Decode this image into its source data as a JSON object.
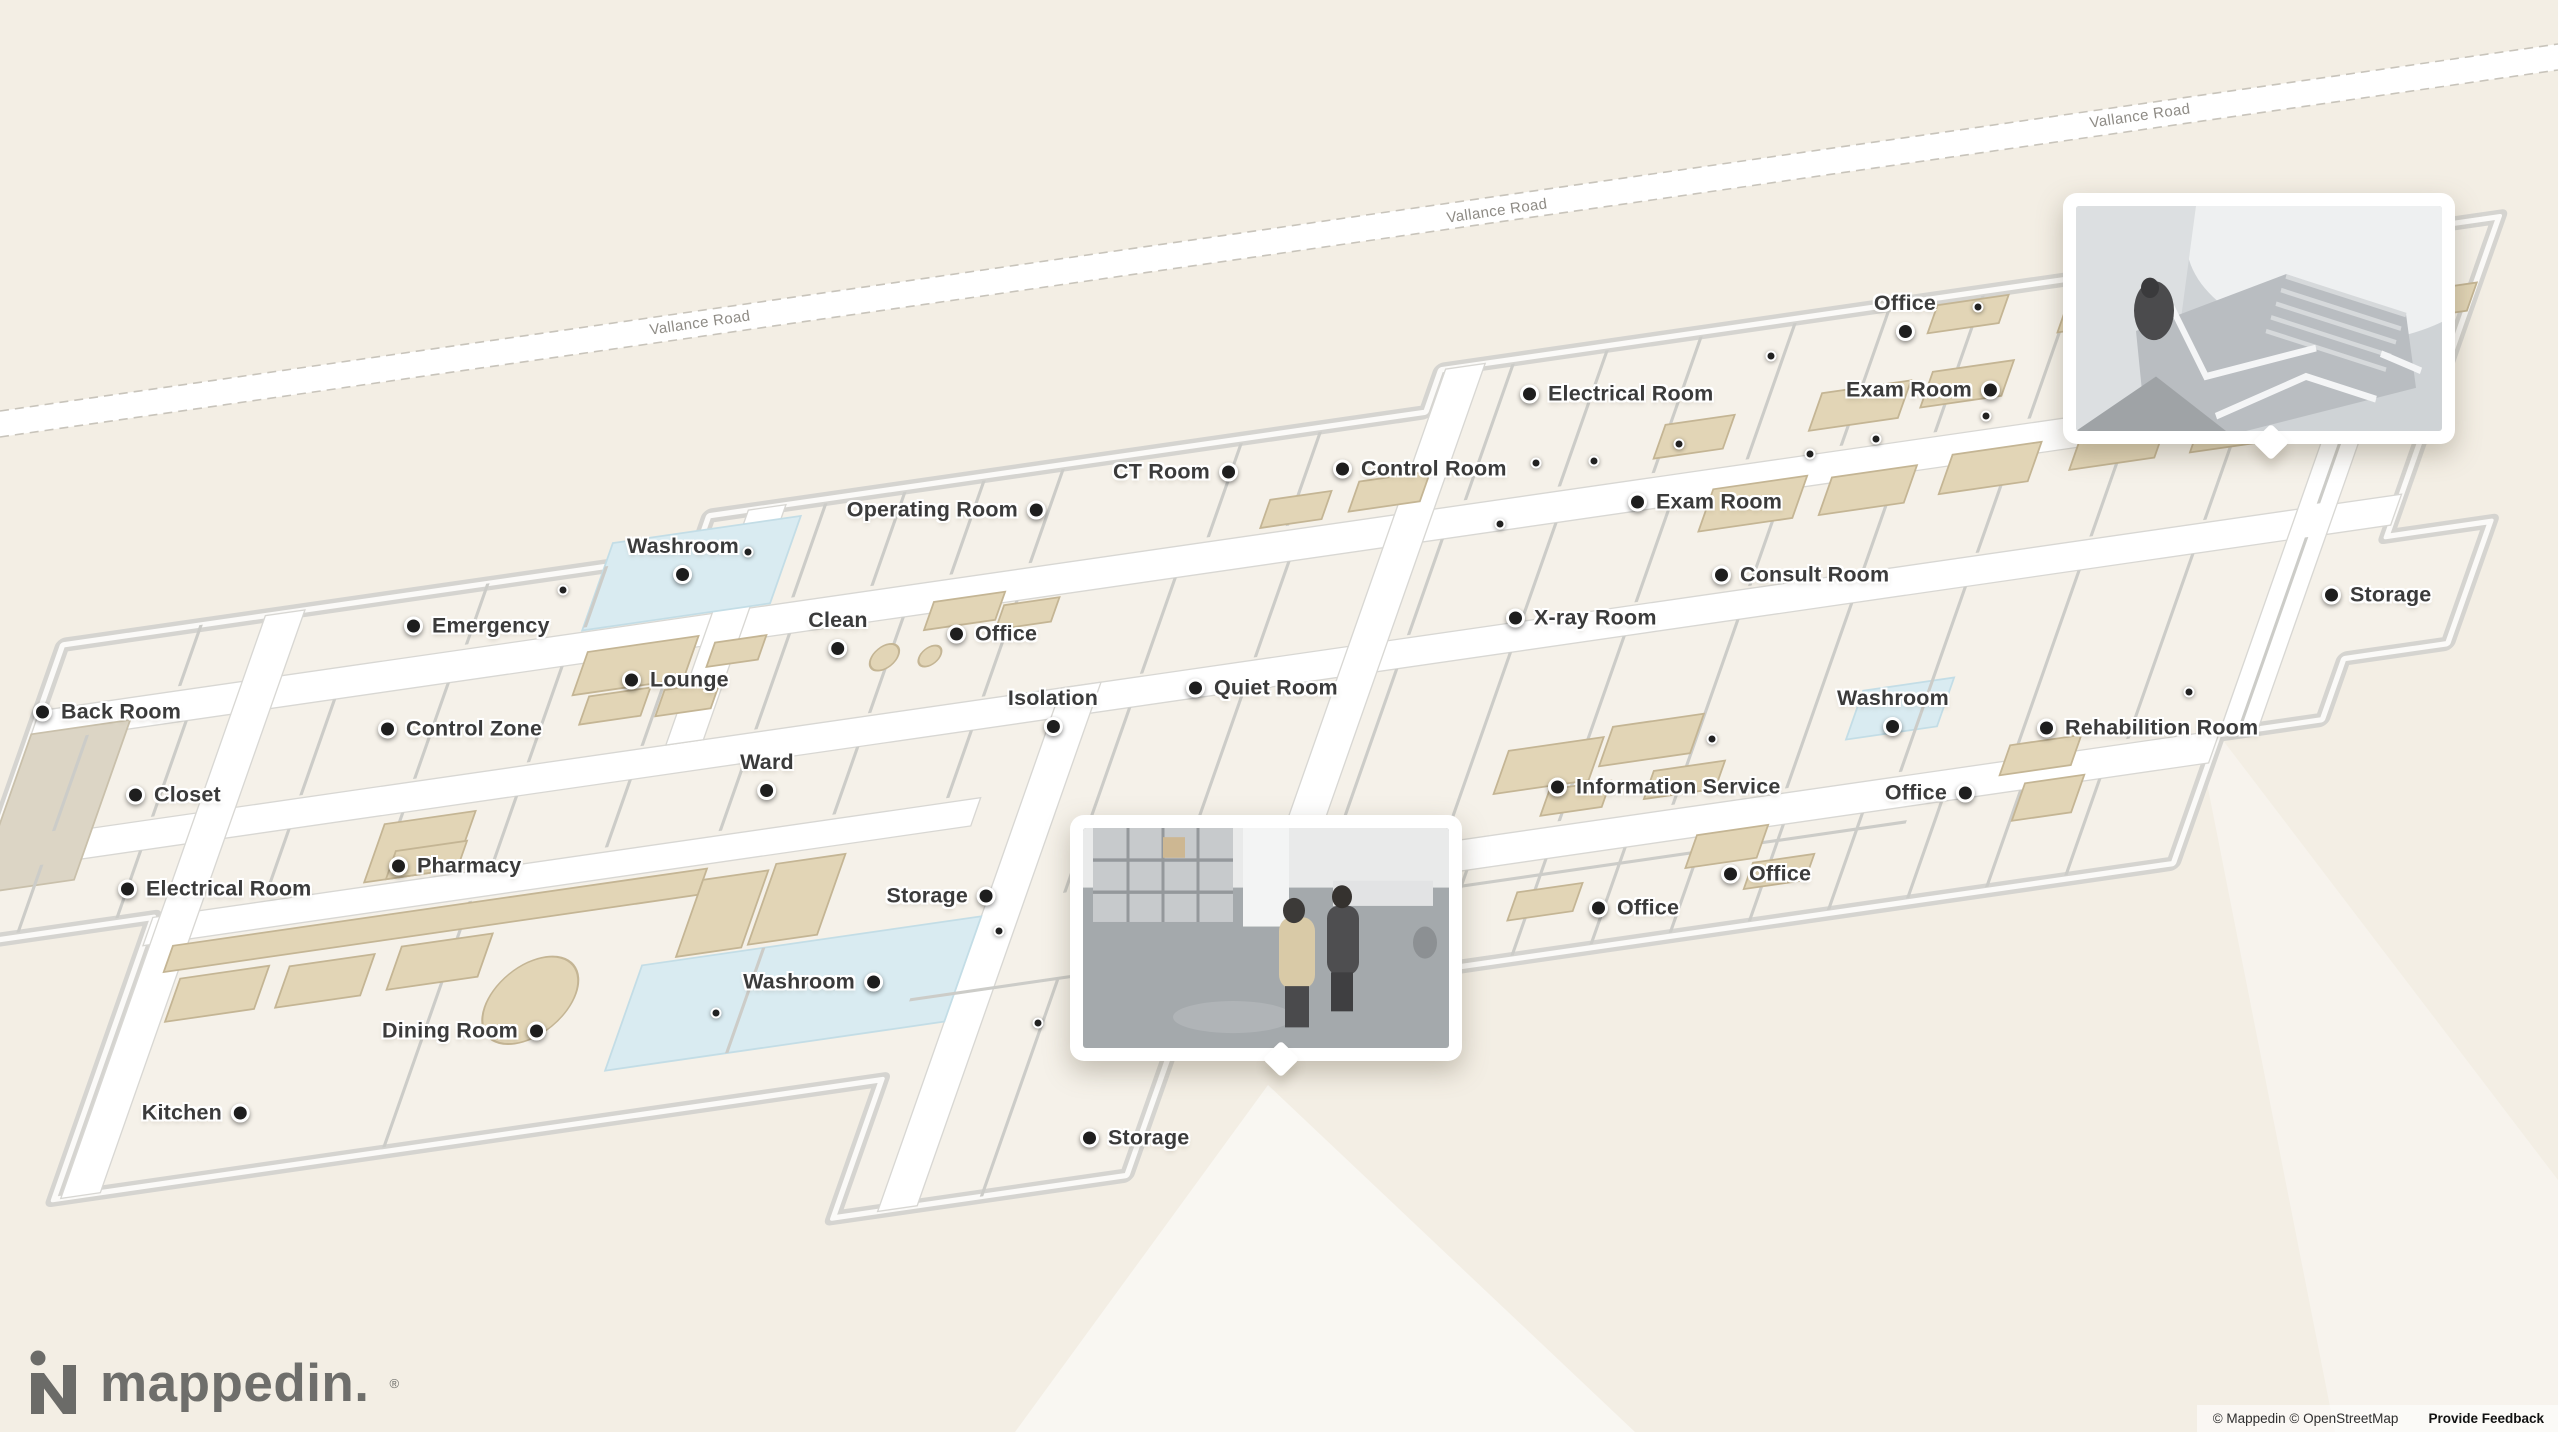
{
  "map": {
    "colors": {
      "background": "#f3eee4",
      "room_floor": "#f5f1e9",
      "wall_gray": "#d5d4d0",
      "washroom_blue": "#d9ebf1",
      "furniture_beige": "#e2d5b6",
      "label_text": "#3b3b3b",
      "marker_black": "#1e1e1e",
      "road_label_gray": "#8e8b85"
    },
    "road": {
      "name": "Vallance Road",
      "labels": [
        {
          "x": 700,
          "y": 323
        },
        {
          "x": 1497,
          "y": 211
        },
        {
          "x": 2140,
          "y": 116
        }
      ]
    },
    "labels": [
      {
        "id": "office-top-right",
        "text": "Office",
        "x": 1905,
        "y": 331,
        "side": "above"
      },
      {
        "id": "electrical-room-right",
        "text": "Electrical Room",
        "x": 1530,
        "y": 394,
        "side": "right"
      },
      {
        "id": "exam-room-top",
        "text": "Exam Room",
        "x": 1990,
        "y": 390,
        "side": "left"
      },
      {
        "id": "exam-room-mid",
        "text": "Exam Room",
        "x": 1638,
        "y": 502,
        "side": "right"
      },
      {
        "id": "consult-room",
        "text": "Consult Room",
        "x": 1722,
        "y": 575,
        "side": "right"
      },
      {
        "id": "control-room",
        "text": "Control Room",
        "x": 1343,
        "y": 469,
        "side": "right"
      },
      {
        "id": "ct-room",
        "text": "CT Room",
        "x": 1228,
        "y": 472,
        "side": "left"
      },
      {
        "id": "operating-room",
        "text": "Operating Room",
        "x": 1036,
        "y": 510,
        "side": "left"
      },
      {
        "id": "washroom-top",
        "text": "Washroom",
        "x": 683,
        "y": 574,
        "side": "above"
      },
      {
        "id": "clean",
        "text": "Clean",
        "x": 838,
        "y": 648,
        "side": "above"
      },
      {
        "id": "office-clean",
        "text": "Office",
        "x": 957,
        "y": 634,
        "side": "right"
      },
      {
        "id": "emergency",
        "text": "Emergency",
        "x": 414,
        "y": 626,
        "side": "right"
      },
      {
        "id": "lounge",
        "text": "Lounge",
        "x": 632,
        "y": 680,
        "side": "right"
      },
      {
        "id": "control-zone",
        "text": "Control Zone",
        "x": 388,
        "y": 729,
        "side": "right"
      },
      {
        "id": "ward",
        "text": "Ward",
        "x": 767,
        "y": 790,
        "side": "above"
      },
      {
        "id": "back-room",
        "text": "Back Room",
        "x": 43,
        "y": 712,
        "side": "right"
      },
      {
        "id": "closet",
        "text": "Closet",
        "x": 136,
        "y": 795,
        "side": "right"
      },
      {
        "id": "electrical-room-left",
        "text": "Electrical Room",
        "x": 128,
        "y": 889,
        "side": "right"
      },
      {
        "id": "pharmacy",
        "text": "Pharmacy",
        "x": 399,
        "y": 866,
        "side": "right"
      },
      {
        "id": "isolation",
        "text": "Isolation",
        "x": 1053,
        "y": 726,
        "side": "above"
      },
      {
        "id": "quiet-room",
        "text": "Quiet Room",
        "x": 1196,
        "y": 688,
        "side": "right"
      },
      {
        "id": "x-ray-room",
        "text": "X-ray Room",
        "x": 1516,
        "y": 618,
        "side": "right"
      },
      {
        "id": "information-service",
        "text": "Information Service",
        "x": 1558,
        "y": 787,
        "side": "right"
      },
      {
        "id": "washroom-right",
        "text": "Washroom",
        "x": 1893,
        "y": 726,
        "side": "above"
      },
      {
        "id": "office-right",
        "text": "Office",
        "x": 1965,
        "y": 793,
        "side": "left"
      },
      {
        "id": "rehabilition-room",
        "text": "Rehabilition Room",
        "x": 2047,
        "y": 728,
        "side": "right"
      },
      {
        "id": "office-mid",
        "text": "Office",
        "x": 1731,
        "y": 874,
        "side": "right"
      },
      {
        "id": "office-bottom",
        "text": "Office",
        "x": 1599,
        "y": 908,
        "side": "right"
      },
      {
        "id": "storage-right",
        "text": "Storage",
        "x": 2332,
        "y": 595,
        "side": "right"
      },
      {
        "id": "storage-mid",
        "text": "Storage",
        "x": 986,
        "y": 896,
        "side": "left"
      },
      {
        "id": "washroom-bottom",
        "text": "Washroom",
        "x": 873,
        "y": 982,
        "side": "left"
      },
      {
        "id": "dining-room",
        "text": "Dining Room",
        "x": 536,
        "y": 1031,
        "side": "left"
      },
      {
        "id": "kitchen",
        "text": "Kitchen",
        "x": 240,
        "y": 1113,
        "side": "left"
      },
      {
        "id": "storage-bottom",
        "text": "Storage",
        "x": 1090,
        "y": 1138,
        "side": "right"
      }
    ],
    "small_dots": [
      [
        748,
        552
      ],
      [
        563,
        590
      ],
      [
        1679,
        444
      ],
      [
        1876,
        439
      ],
      [
        1986,
        416
      ],
      [
        1810,
        454
      ],
      [
        1594,
        461
      ],
      [
        1536,
        463
      ],
      [
        1500,
        524
      ],
      [
        1771,
        356
      ],
      [
        1978,
        307
      ],
      [
        2367,
        323
      ],
      [
        1712,
        739
      ],
      [
        2189,
        692
      ],
      [
        999,
        931
      ],
      [
        716,
        1013
      ],
      [
        1038,
        1023
      ]
    ]
  },
  "popups": {
    "stairwell": {
      "x": 2063,
      "y": 193,
      "w": 392,
      "h": 251,
      "tail_x": 195
    },
    "room": {
      "x": 1070,
      "y": 815,
      "w": 392,
      "h": 246,
      "tail_x": 198
    }
  },
  "logo": {
    "brand": "mappedin.",
    "registered": "®"
  },
  "attribution": {
    "text": "© Mappedin © OpenStreetMap",
    "feedback": "Provide Feedback"
  }
}
